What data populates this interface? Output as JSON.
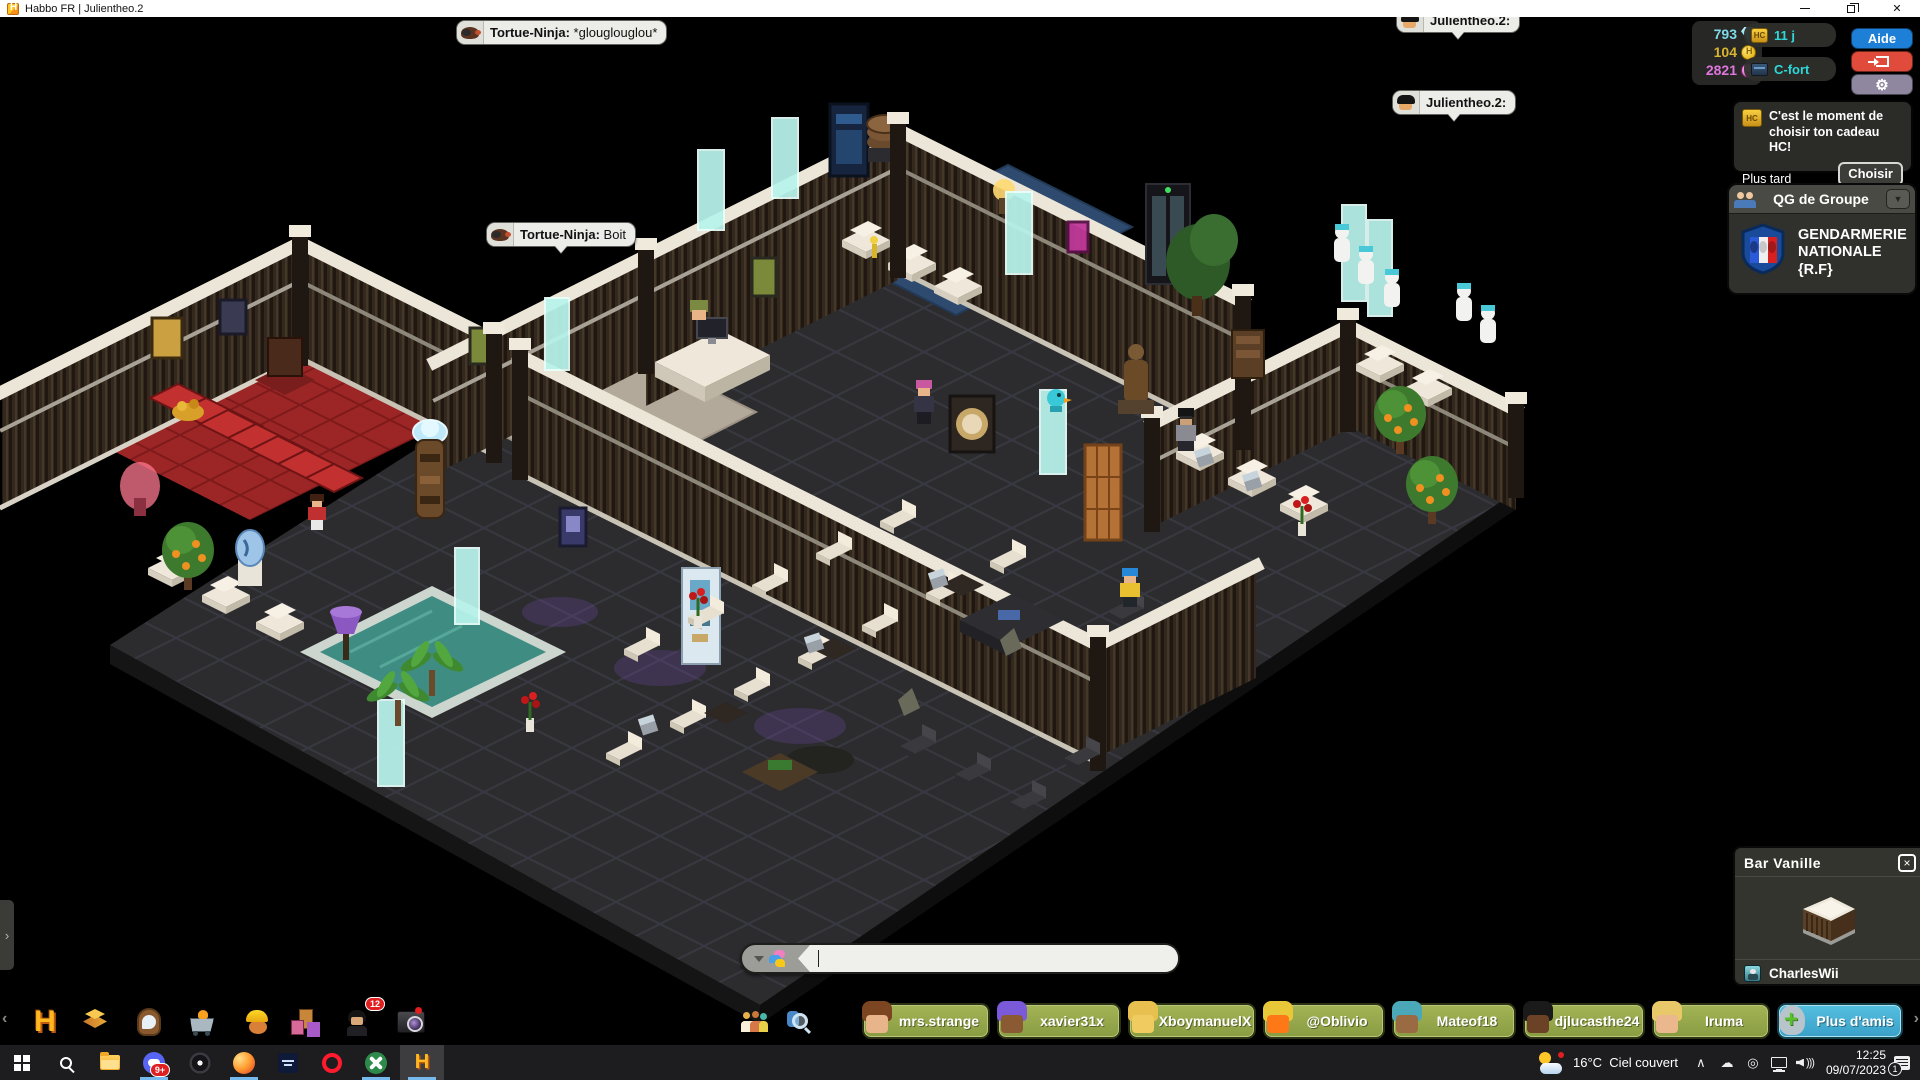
{
  "window": {
    "title": "Habbo FR | Julientheo.2"
  },
  "hud": {
    "diamonds": "793",
    "coins": "104",
    "duckets": "2821",
    "hc_days": "11 j",
    "cfort": "C-fort",
    "aide": "Aide"
  },
  "notification": {
    "message": "C'est le moment de choisir ton cadeau HC!",
    "later_label": "Plus tard",
    "choose_label": "Choisir"
  },
  "group_panel": {
    "title": "QG de Groupe",
    "group_name": "GENDARMERIE NATIONALE {R.F}"
  },
  "furni_panel": {
    "title": "Bar Vanille",
    "owner": "CharlesWii"
  },
  "chat": {
    "bubbles": [
      {
        "user": "Tortue-Ninja:",
        "message": "*glouglouglou*"
      },
      {
        "user": "Julientheo.2:",
        "message": ""
      },
      {
        "user": "Julientheo.2:",
        "message": ""
      },
      {
        "user": "Tortue-Ninja:",
        "message": "Boit"
      }
    ],
    "input_value": ""
  },
  "toolbar": {
    "messenger_badge": "12",
    "friends": [
      {
        "name": "mrs.strange"
      },
      {
        "name": "xavier31x"
      },
      {
        "name": "XboymanuelX"
      },
      {
        "name": "@Oblivio"
      },
      {
        "name": "Mateof18"
      },
      {
        "name": "djlucasthe24"
      },
      {
        "name": "Iruma"
      }
    ],
    "more_friends": "Plus d'amis"
  },
  "taskbar": {
    "discord_badge": "9+",
    "weather_temp": "16°C",
    "weather_desc": "Ciel couvert",
    "time": "12:25",
    "date": "09/07/2023",
    "notifications": "1"
  },
  "colors": {
    "accent_cyan": "#2fd8d8",
    "aide_blue": "#1d7fd6",
    "logout_red": "#e14b3b",
    "friend_green": "#95a74b",
    "more_blue": "#49b4d8",
    "taskbar_underline": "#76b9ed"
  }
}
